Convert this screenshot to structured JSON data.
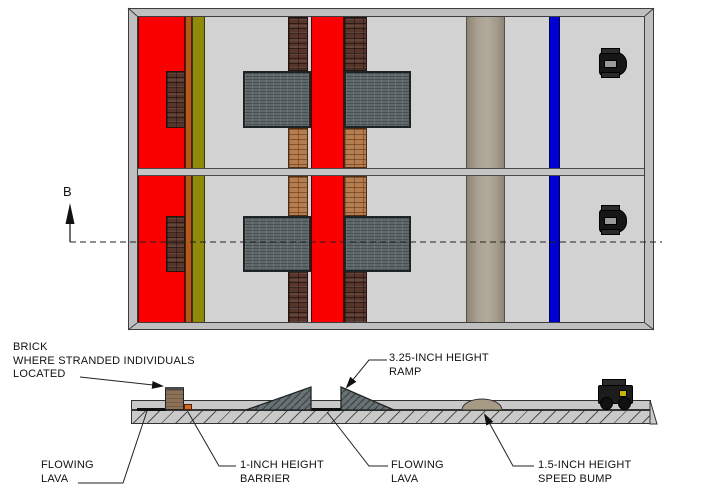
{
  "drawing": {
    "section_marker": {
      "letter": "B"
    },
    "labels": {
      "brick": {
        "line1": "BRICK",
        "line2": "WHERE STRANDED INDIVIDUALS",
        "line3": "LOCATED"
      },
      "ramp": {
        "line1": "3.25-INCH HEIGHT",
        "line2": "RAMP"
      },
      "lava_left": {
        "line1": "FLOWING",
        "line2": "LAVA"
      },
      "barrier": {
        "line1": "1-INCH HEIGHT",
        "line2": "BARRIER"
      },
      "lava_right": {
        "line1": "FLOWING",
        "line2": "LAVA"
      },
      "speed_bump": {
        "line1": "1.5-INCH HEIGHT",
        "line2": "SPEED BUMP"
      }
    },
    "colors": {
      "lava_red": "#FA0000",
      "barrier_orange": "#B4591B",
      "olive_stripe": "#8F8A0A",
      "finish_blue": "#0000D2",
      "floor_gray": "#D2D2D2",
      "wall_gray": "#BFBFBF",
      "ramp_gray": "#5F696B",
      "dark_brick": "#57352B",
      "tan_brick": "#B57D50",
      "speed_bump_tan": "#AAA292",
      "section_floor": "#C9C9C9",
      "section_brick_brown": "#8C7158",
      "dome_tan": "#A79B85",
      "robot_dark": "#1C1C1C"
    }
  }
}
